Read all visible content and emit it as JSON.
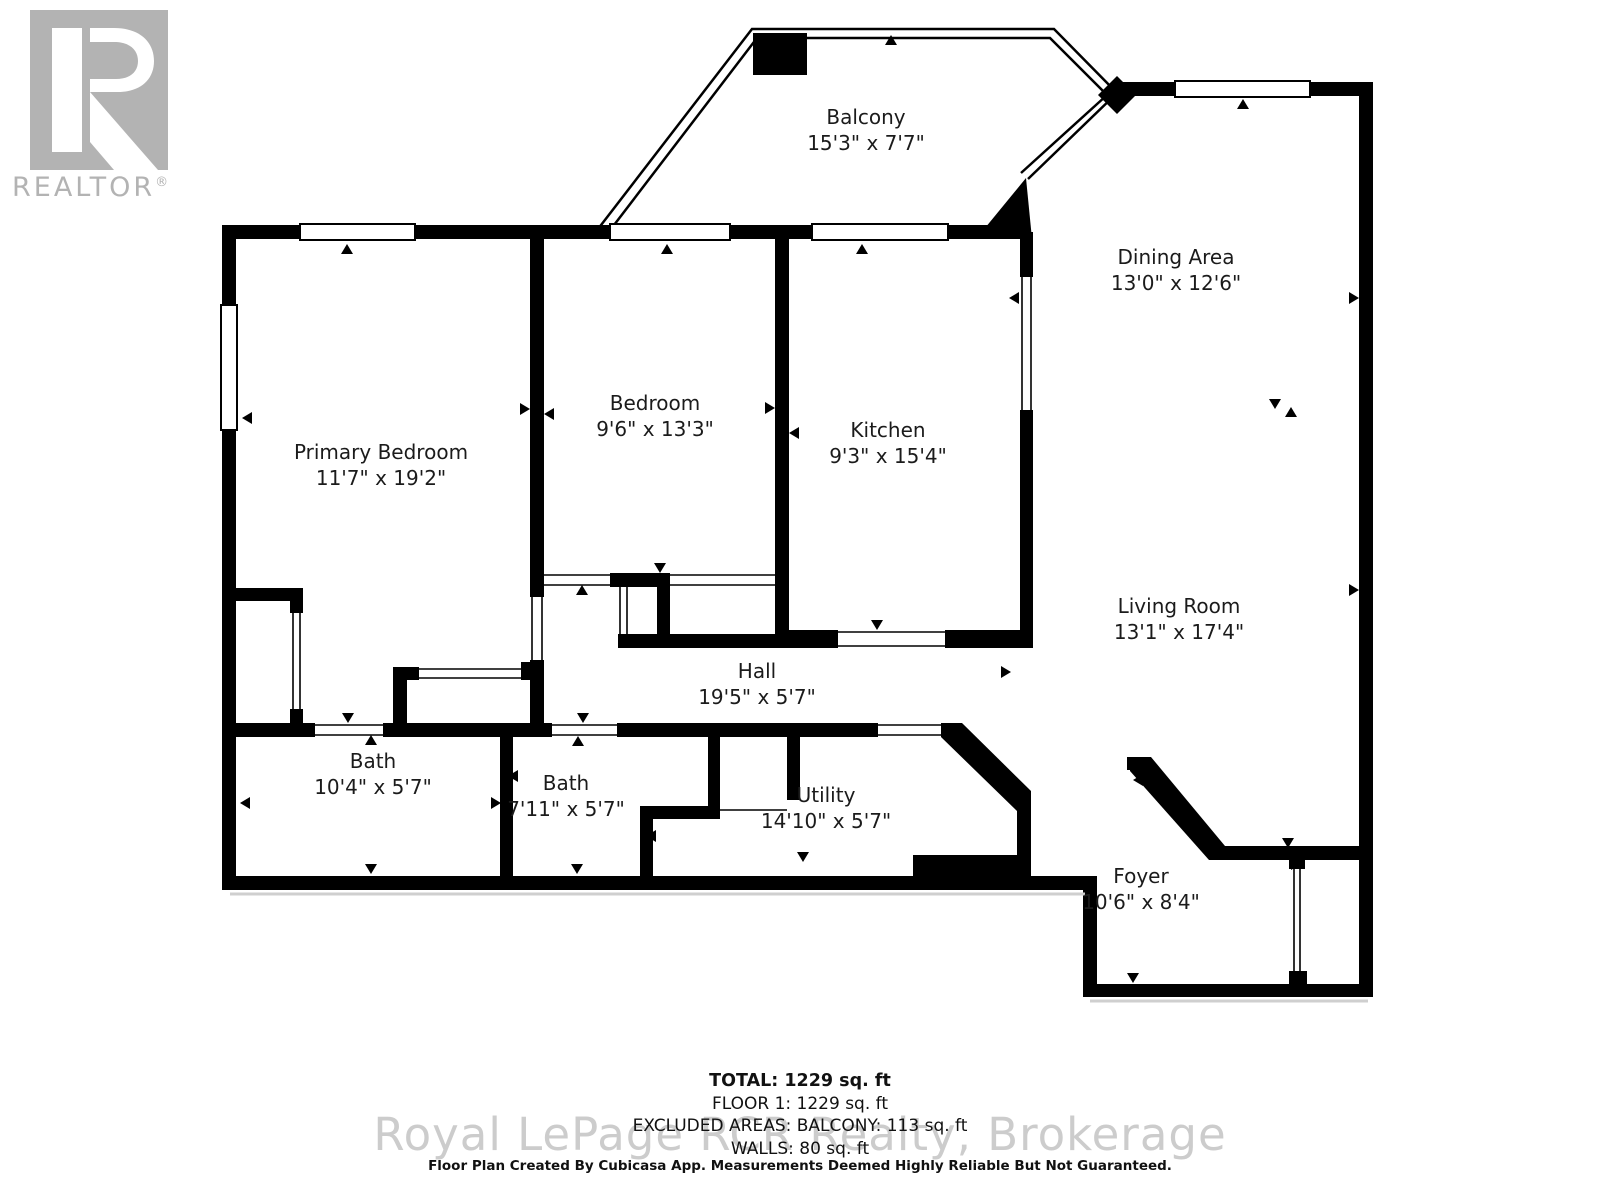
{
  "logo": {
    "symbol": "R",
    "brand": "REALTOR",
    "registered": "®",
    "gray": "#b3b3b3"
  },
  "rooms": [
    {
      "name": "Balcony",
      "dims": "15'3\" x 7'7\"",
      "x": 866,
      "y": 104
    },
    {
      "name": "Dining Area",
      "dims": "13'0\" x 12'6\"",
      "x": 1176,
      "y": 244
    },
    {
      "name": "Primary Bedroom",
      "dims": "11'7\" x 19'2\"",
      "x": 381,
      "y": 439
    },
    {
      "name": "Bedroom",
      "dims": "9'6\" x 13'3\"",
      "x": 655,
      "y": 390
    },
    {
      "name": "Kitchen",
      "dims": "9'3\" x 15'4\"",
      "x": 888,
      "y": 417
    },
    {
      "name": "Living Room",
      "dims": "13'1\" x 17'4\"",
      "x": 1179,
      "y": 593
    },
    {
      "name": "Hall",
      "dims": "19'5\" x 5'7\"",
      "x": 757,
      "y": 658
    },
    {
      "name": "Bath",
      "dims": "10'4\" x 5'7\"",
      "x": 373,
      "y": 748
    },
    {
      "name": "Bath",
      "dims": "7'11\" x 5'7\"",
      "x": 566,
      "y": 770
    },
    {
      "name": "Utility",
      "dims": "14'10\" x 5'7\"",
      "x": 826,
      "y": 782
    },
    {
      "name": "Foyer",
      "dims": "10'6\" x 8'4\"",
      "x": 1141,
      "y": 863
    }
  ],
  "summary": {
    "total": "TOTAL: 1229 sq. ft",
    "floor1": "FLOOR 1: 1229 sq. ft",
    "excluded": "EXCLUDED AREAS: BALCONY: 113 sq. ft",
    "walls": "WALLS: 80 sq. ft"
  },
  "watermark": "Royal LePage RCR Realty, Brokerage",
  "disclaimer": "Floor Plan Created By Cubicasa App. Measurements Deemed Highly Reliable But Not Guaranteed.",
  "colors": {
    "wall": "#000000",
    "label_text": "#1b1b1b",
    "watermark_gray": "#cccccc",
    "logo_gray": "#b3b3b3"
  }
}
